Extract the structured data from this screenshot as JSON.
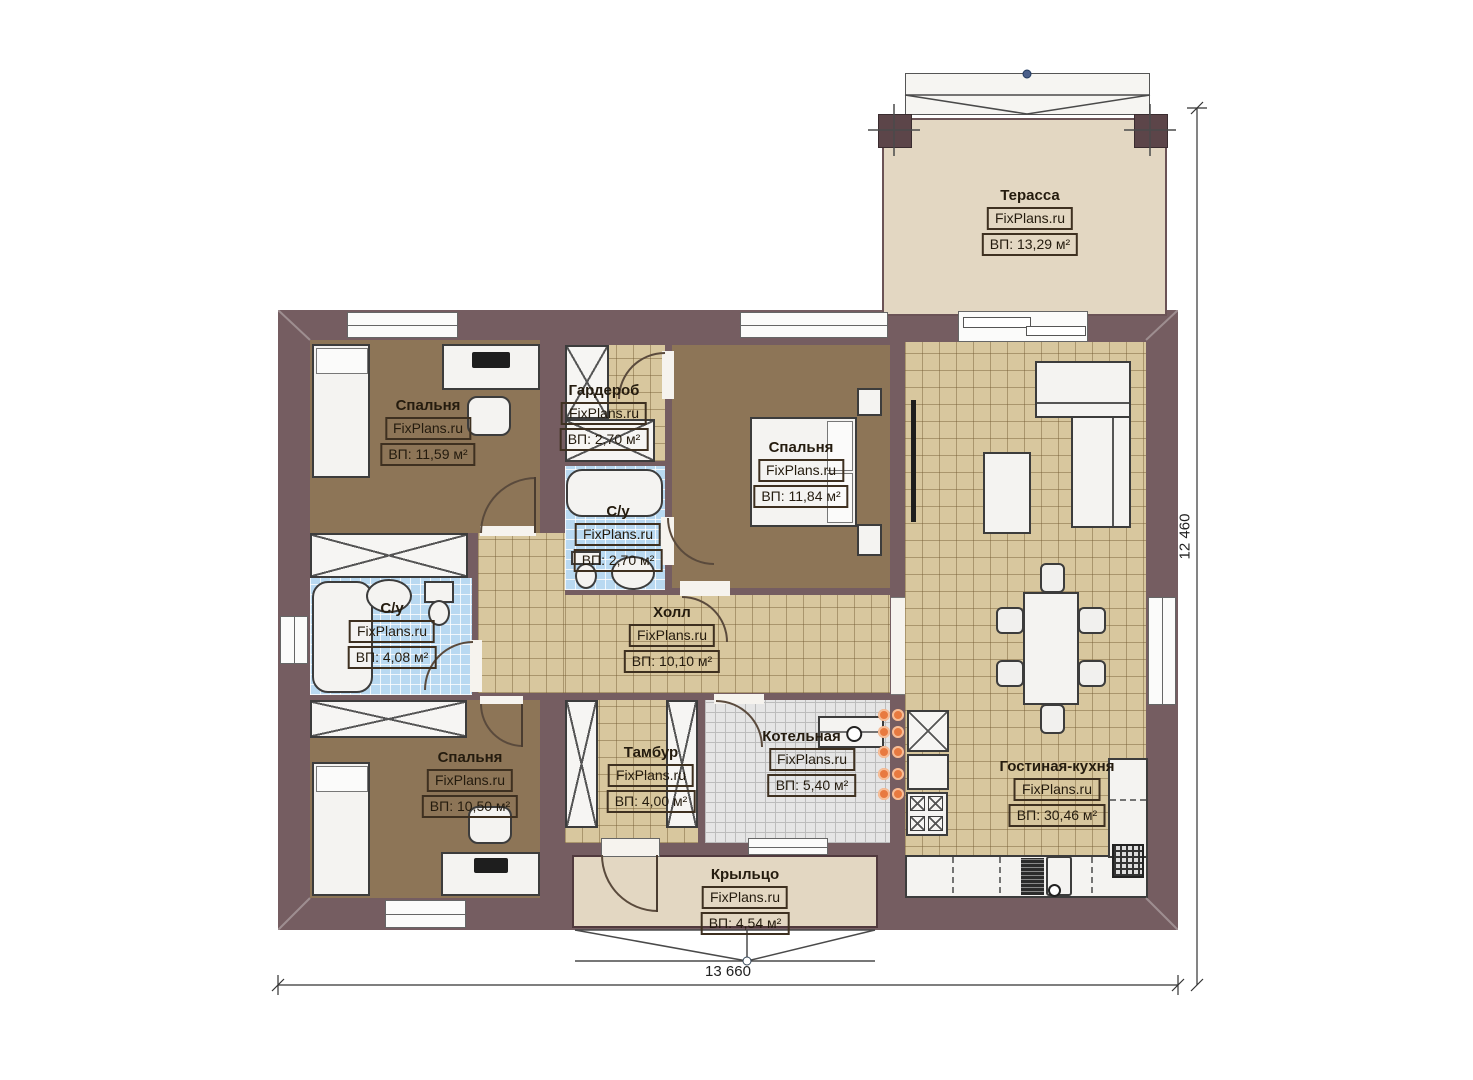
{
  "watermark": "FixPlans.ru",
  "rooms": [
    {
      "name": "Терасса",
      "area": "ВП: 13,29 м²"
    },
    {
      "name": "Спальня",
      "area": "ВП: 11,59 м²"
    },
    {
      "name": "Гардероб",
      "area": "ВП: 2,70 м²"
    },
    {
      "name": "Спальня",
      "area": "ВП: 11,84 м²"
    },
    {
      "name": "С/у",
      "area": "ВП: 2,70 м²"
    },
    {
      "name": "С/у",
      "area": "ВП: 4,08 м²"
    },
    {
      "name": "Холл",
      "area": "ВП: 10,10 м²"
    },
    {
      "name": "Спальня",
      "area": "ВП: 10,50 м²"
    },
    {
      "name": "Тамбур",
      "area": "ВП: 4,00 м²"
    },
    {
      "name": "Котельная",
      "area": "ВП: 5,40 м²"
    },
    {
      "name": "Гостиная-кухня",
      "area": "ВП: 30,46 м²"
    },
    {
      "name": "Крыльцо",
      "area": "ВП: 4,54 м²"
    }
  ],
  "dimensions": {
    "bottom": "13 660",
    "right": "12 460"
  },
  "colors": {
    "wall": "#755d61",
    "floor_wood": "#8d7557",
    "floor_tile": "#d8c79e",
    "floor_bath": "#b9d9f1",
    "floor_boiler": "#e5e5e5",
    "floor_terrace": "#e3d7c2",
    "radiator_dot": "#e87a40"
  }
}
